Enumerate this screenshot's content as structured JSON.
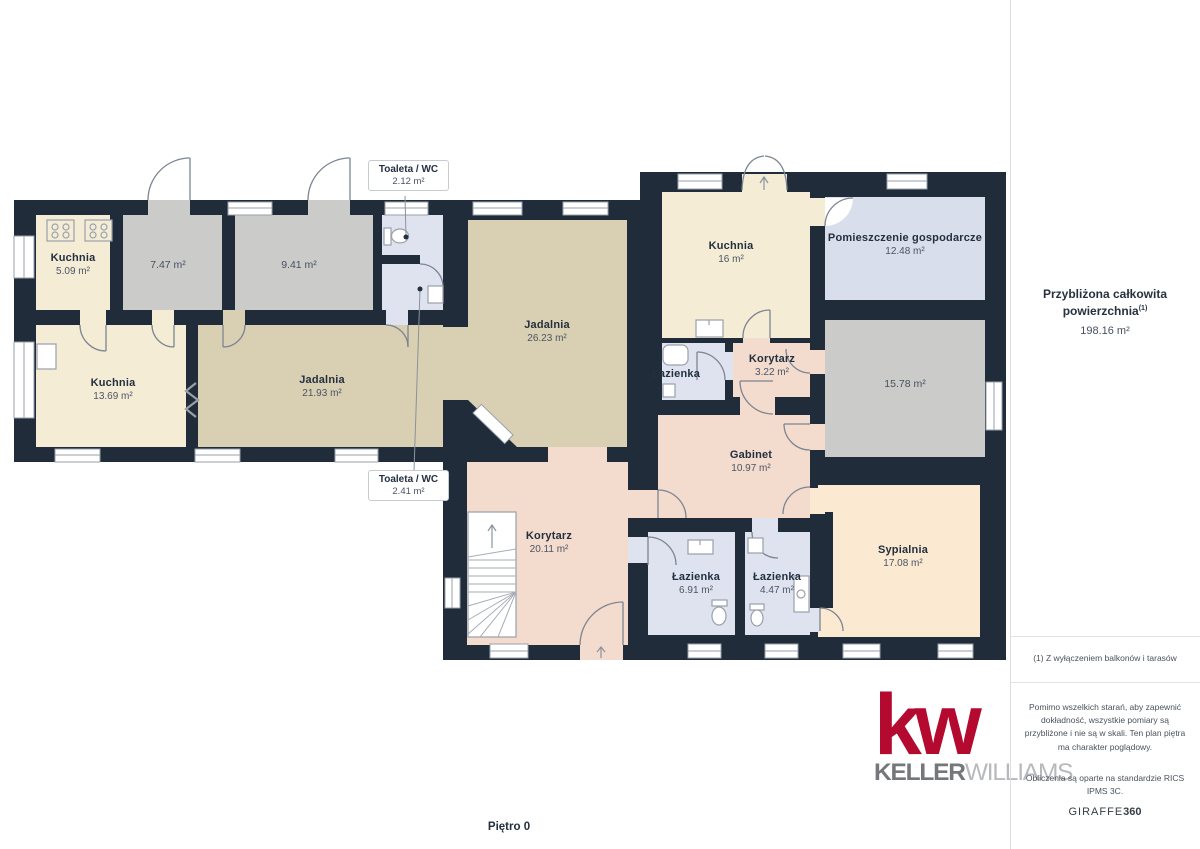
{
  "floor_label": "Piętro 0",
  "rooms": {
    "kuchnia5": {
      "name": "Kuchnia",
      "area": "5.09 m²"
    },
    "r747": {
      "area": "7.47 m²"
    },
    "r941": {
      "area": "9.41 m²"
    },
    "jadalnia26": {
      "name": "Jadalnia",
      "area": "26.23 m²"
    },
    "kuchnia16": {
      "name": "Kuchnia",
      "area": "16 m²"
    },
    "pomieszczenie": {
      "name": "Pomieszczenie gospodarcze",
      "area": "12.48 m²"
    },
    "kuchnia13": {
      "name": "Kuchnia",
      "area": "13.69 m²"
    },
    "jadalnia21": {
      "name": "Jadalnia",
      "area": "21.93 m²"
    },
    "lazienka_mid": {
      "name": "Łazienka"
    },
    "korytarz3": {
      "name": "Korytarz",
      "area": "3.22 m²"
    },
    "r1578": {
      "area": "15.78 m²"
    },
    "gabinet": {
      "name": "Gabinet",
      "area": "10.97 m²"
    },
    "korytarz20": {
      "name": "Korytarz",
      "area": "20.11 m²"
    },
    "lazienka691": {
      "name": "Łazienka",
      "area": "6.91 m²"
    },
    "lazienka447": {
      "name": "Łazienka",
      "area": "4.47 m²"
    },
    "sypialnia": {
      "name": "Sypialnia",
      "area": "17.08 m²"
    }
  },
  "callouts": [
    {
      "name": "Toaleta / WC",
      "area": "2.12 m²"
    },
    {
      "name": "Toaleta / WC",
      "area": "2.41 m²"
    }
  ],
  "sidebar": {
    "title": "Przybliżona całkowita powierzchnia",
    "title_sup": "(1)",
    "total_area": "198.16 m²",
    "footnote": "(1) Z wyłączeniem balkonów i tarasów",
    "disclaimer": "Pomimo wszelkich starań, aby zapewnić dokładność, wszystkie pomiary są przybliżone i nie są w skali. Ten plan piętra ma charakter poglądowy.",
    "standard": "Obliczenia są oparte na standardzie RICS IPMS 3C.",
    "brand_name": "GIRAFFE",
    "brand_suffix": "360"
  },
  "logo": {
    "mark": "kw",
    "word1": "KELLER",
    "word2": "WILLIAMS"
  },
  "colors": {
    "wall": "#202c3a",
    "room_cream": "#f5ecd6",
    "room_gray": "#cbcbca",
    "room_tan": "#d9cfb2",
    "room_pink": "#f3dbcd",
    "room_peach": "#fbe9d1",
    "room_blue": "#dfe3f0",
    "room_bluegray": "#d8deeb",
    "kw_red": "#b40a30"
  }
}
